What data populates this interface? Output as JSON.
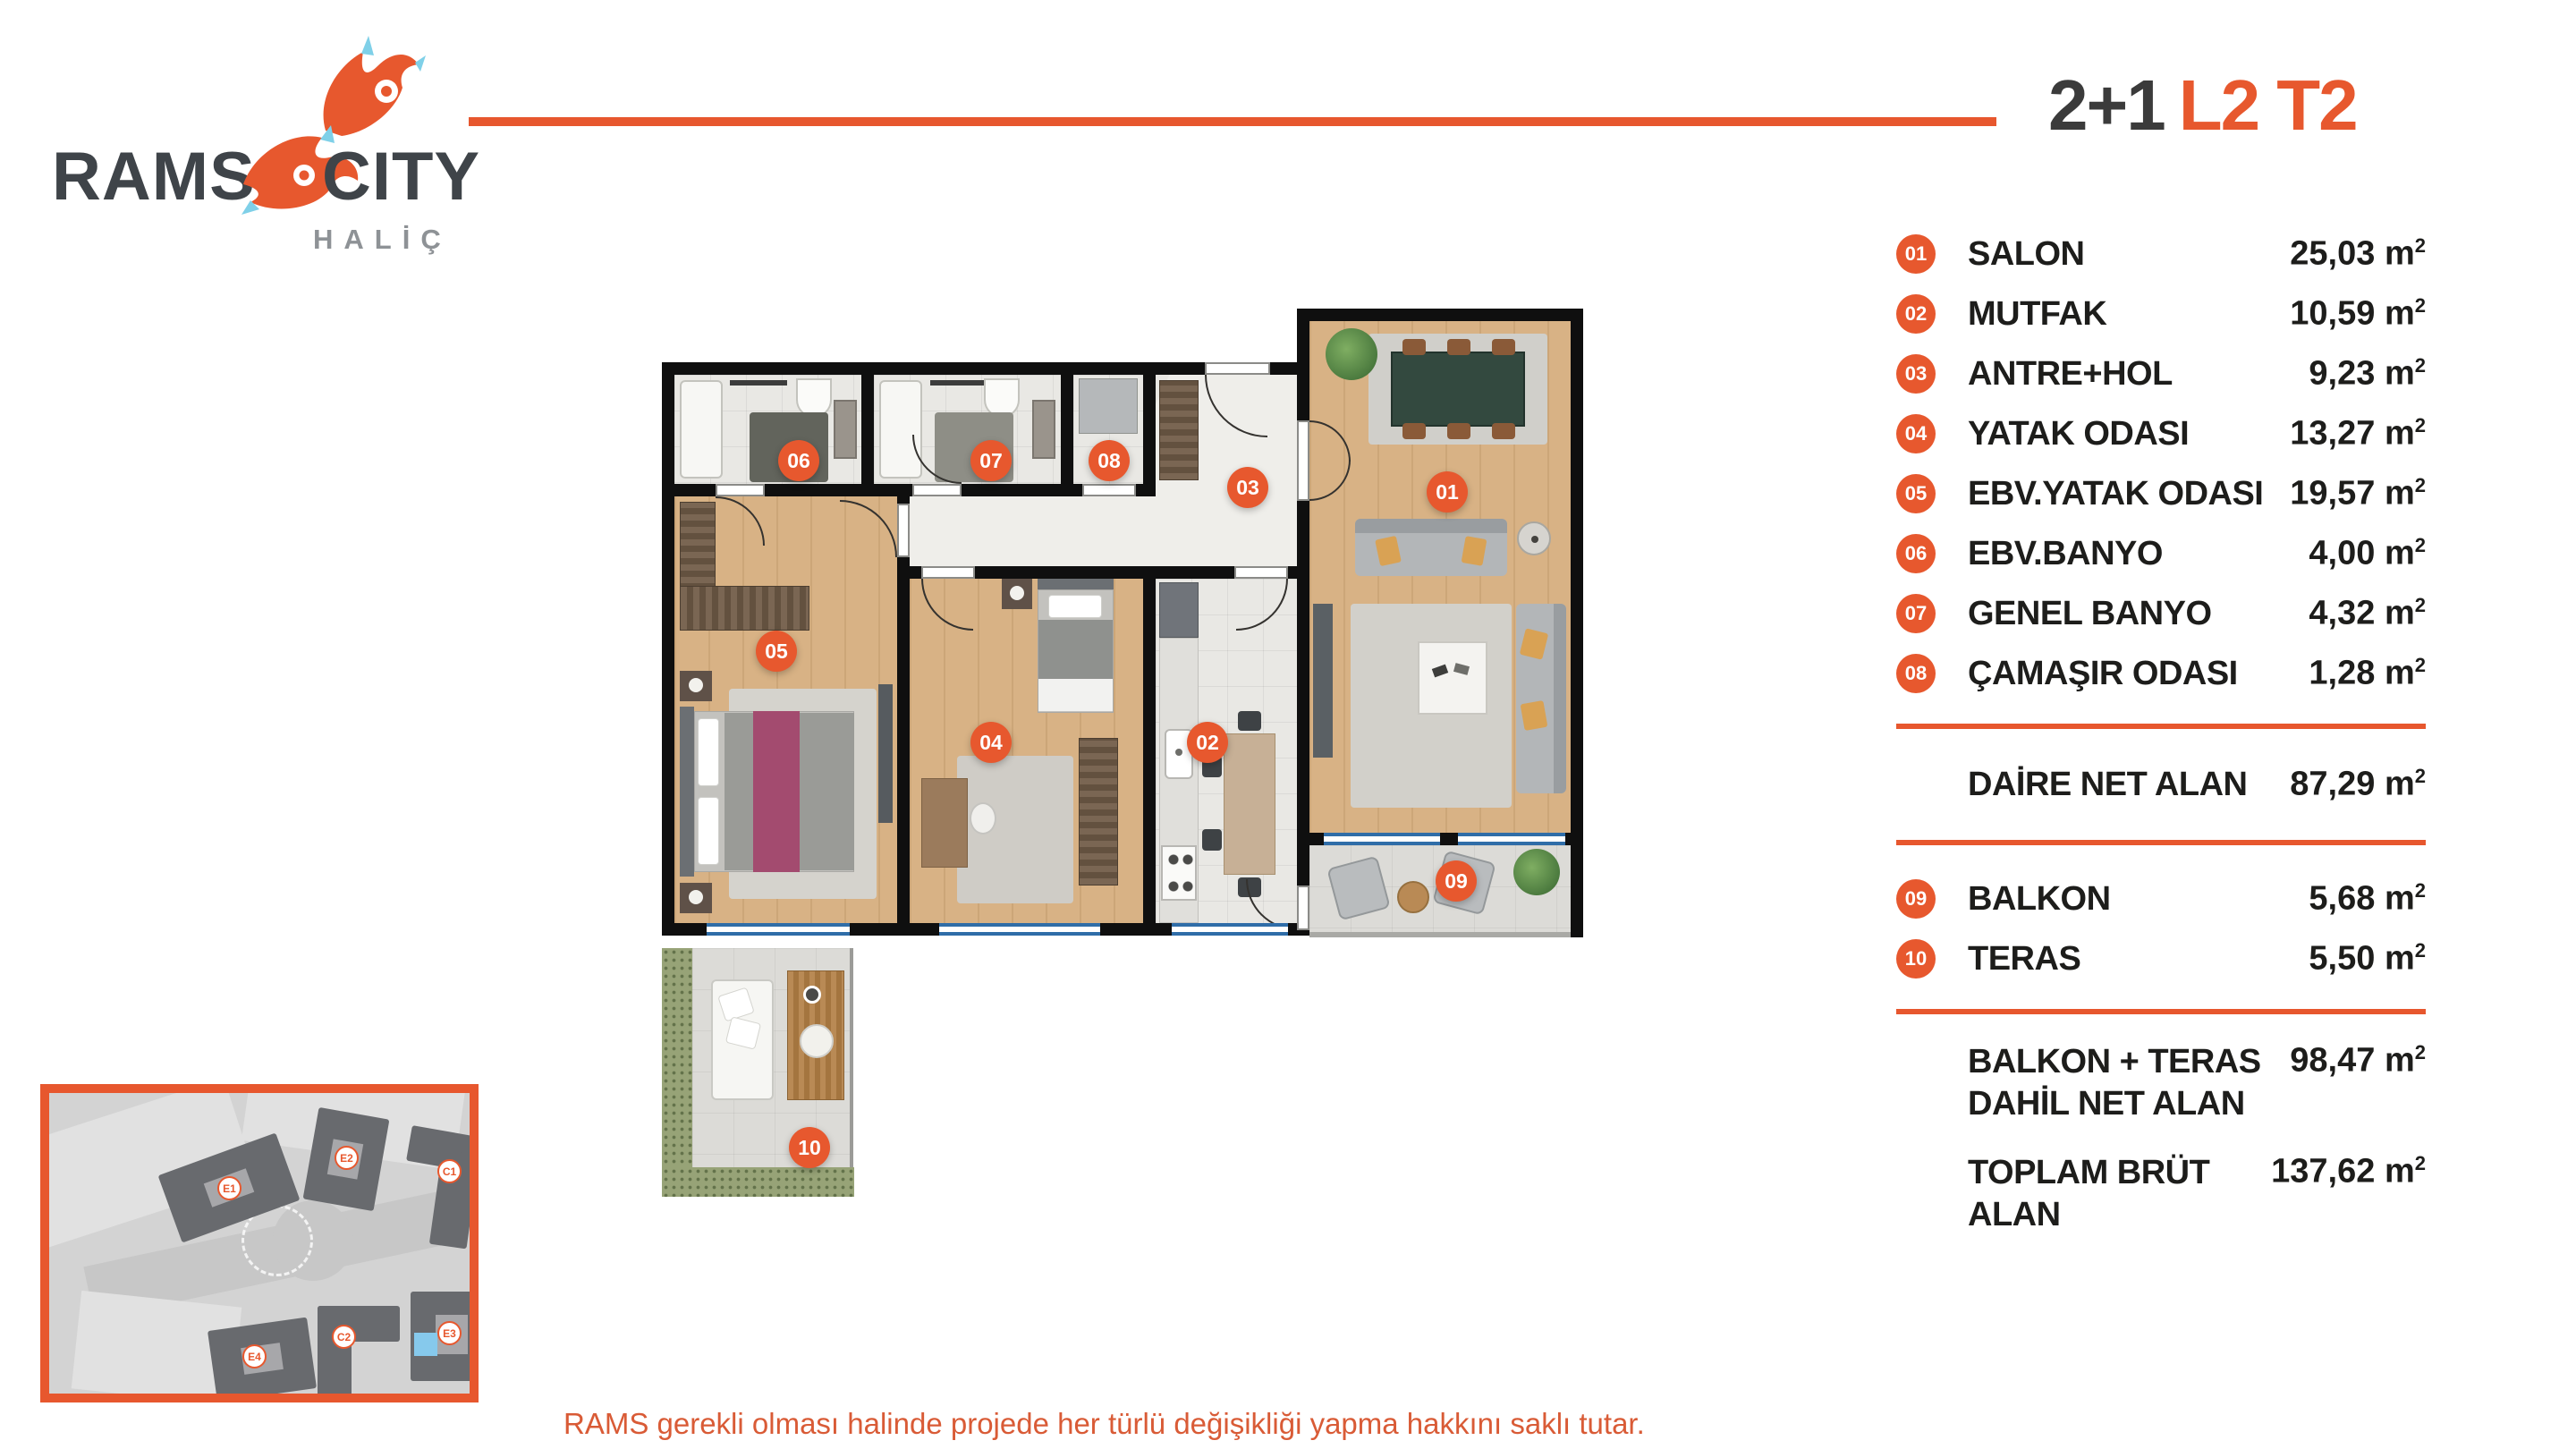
{
  "brand": {
    "rams": "RAMS",
    "city": "CITY",
    "subtitle": "HALİÇ"
  },
  "title": {
    "type": "2+1",
    "code": "L2 T2"
  },
  "legend": {
    "unit_m": "m",
    "unit_exp": "2",
    "rooms": [
      {
        "no": "01",
        "label": "SALON",
        "area": "25,03"
      },
      {
        "no": "02",
        "label": "MUTFAK",
        "area": "10,59"
      },
      {
        "no": "03",
        "label": "ANTRE+HOL",
        "area": "9,23"
      },
      {
        "no": "04",
        "label": "YATAK ODASI",
        "area": "13,27"
      },
      {
        "no": "05",
        "label": "EBV.YATAK ODASI",
        "area": "19,57"
      },
      {
        "no": "06",
        "label": "EBV.BANYO",
        "area": "4,00"
      },
      {
        "no": "07",
        "label": "GENEL BANYO",
        "area": "4,32"
      },
      {
        "no": "08",
        "label": "ÇAMAŞIR ODASI",
        "area": "1,28"
      }
    ],
    "net": {
      "label": "DAİRE NET ALAN",
      "area": "87,29"
    },
    "outdoor": [
      {
        "no": "09",
        "label": "BALKON",
        "area": "5,68"
      },
      {
        "no": "10",
        "label": "TERAS",
        "area": "5,50"
      }
    ],
    "totals": [
      {
        "label": "BALKON + TERAS DAHİL NET ALAN",
        "area": "98,47"
      },
      {
        "label": "TOPLAM BRÜT ALAN",
        "area": "137,62"
      }
    ]
  },
  "plan": {
    "badges": [
      "01",
      "02",
      "03",
      "04",
      "05",
      "06",
      "07",
      "08",
      "09",
      "10"
    ]
  },
  "siteplan": {
    "buildings": [
      "E1",
      "E2",
      "C1",
      "E4",
      "C2",
      "E3"
    ]
  },
  "disclaimer": {
    "line1": "RAMS gerekli olması halinde projede her türlü değişikliği yapma hakkını saklı tutar.",
    "line2": "Dairenin bulunduğu konuma göre m2’ler değişiklik gösterebilir. Görselde bulunan konsepti ve tefriş bilgi amaçlıdır."
  },
  "colors": {
    "accent": "#e7582e",
    "dark_text": "#3b3b3b",
    "wall": "#0f0f0f"
  }
}
